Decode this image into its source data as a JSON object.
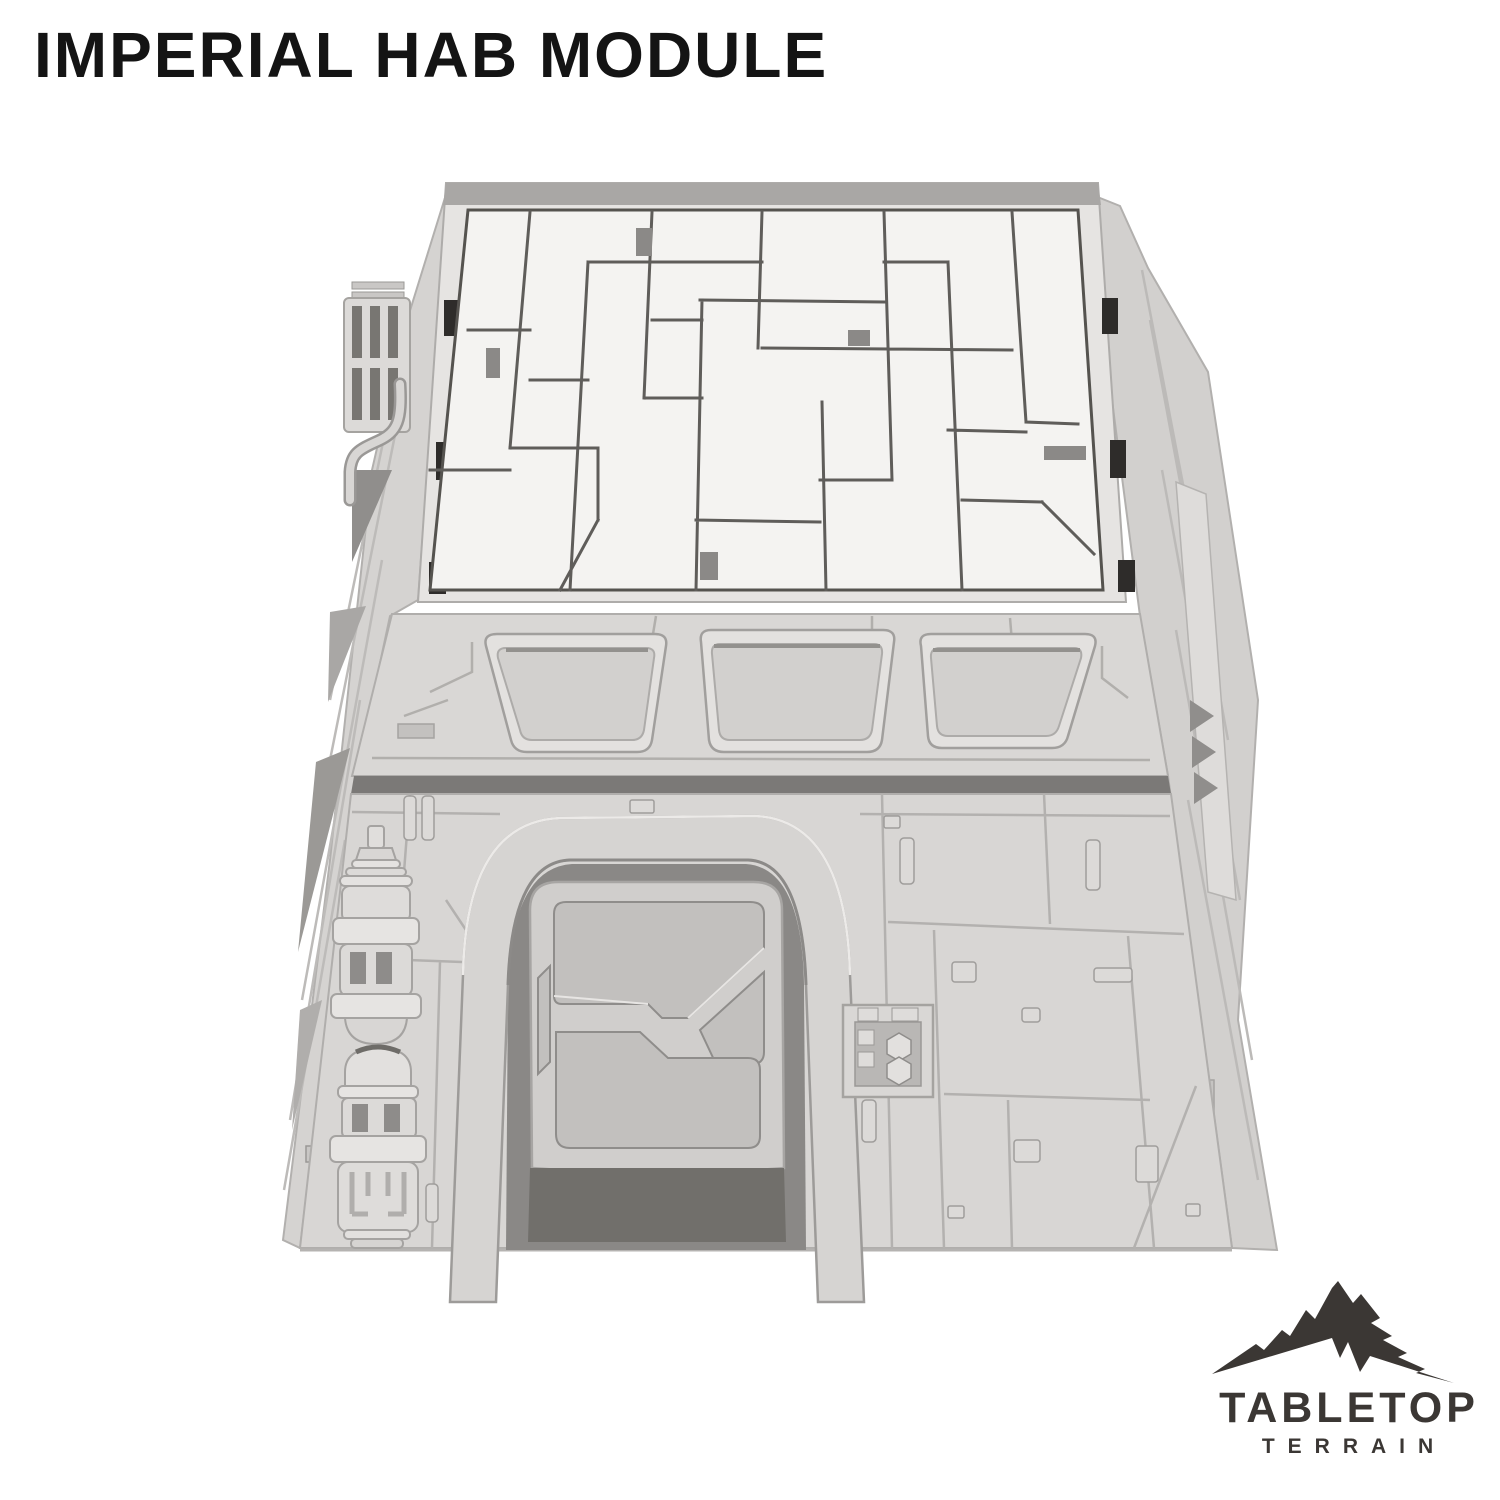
{
  "page": {
    "background_color": "#ffffff"
  },
  "header": {
    "title": "IMPERIAL HAB MODULE",
    "title_color": "#141414"
  },
  "product_render": {
    "name": "imperial-hab-module-3d-render",
    "style": "unpainted light-gray 3D render of a sci-fi tabletop terrain building",
    "features": [
      "flat roof with irregular greeble panel lines",
      "raised roof rim with dark notches",
      "sloped band with three recessed trapezoidal windows",
      "trapezoidal front wall with engraved panel grid and raised studs",
      "arched blast-door frame with angular inset door",
      "two stacked cylindrical tank greebles on the left",
      "small hex-button control box right of the door",
      "vent grille and pipe detail on upper-left wall",
      "sloped side walls with diagonal panel streaks"
    ],
    "colors": {
      "wall_base": "#d8d6d4",
      "roof_top": "#f4f3f1",
      "panel_groove": "#aaa8a6",
      "deep_crevice": "#55524e",
      "recess": "#c6c4c2",
      "notch_black": "#2e2c2a"
    }
  },
  "logo": {
    "brand": "TABLETOP",
    "sub_brand": "TERRAIN",
    "color": "#3b3734",
    "icon": "mountain-icon"
  }
}
